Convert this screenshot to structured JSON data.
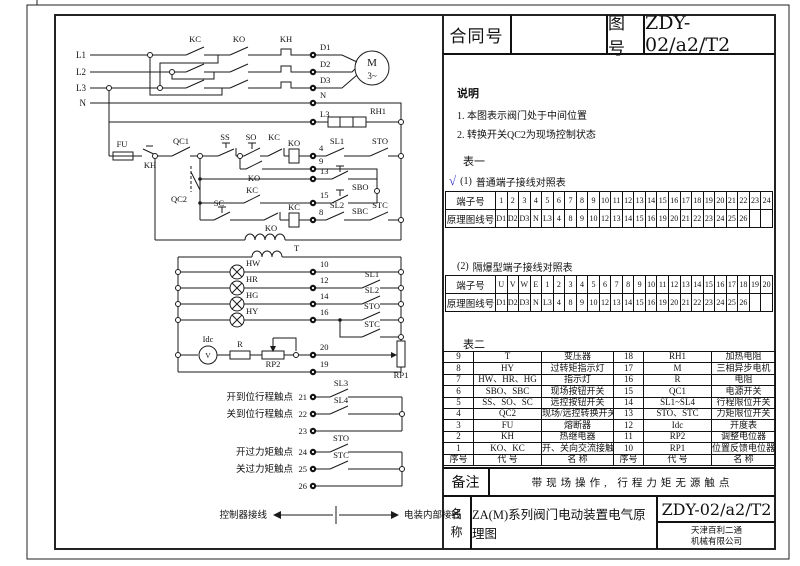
{
  "header": {
    "contract_label": "合同号",
    "contract_value": "",
    "drawing_label": "图号",
    "drawing_value": "ZDY-02/a2/T2"
  },
  "notes": {
    "title": "说明",
    "items": [
      "1. 本图表示阀门处于中间位置",
      "2. 转换开关QC2为现场控制状态"
    ]
  },
  "table1": {
    "title": "表一",
    "check": "√",
    "sub1_label": "(1)",
    "sub1_title": "普通端子接线对照表",
    "row1_header": "端子号",
    "row2_header": "原理图线号",
    "terminals": [
      "1",
      "2",
      "3",
      "4",
      "5",
      "6",
      "7",
      "8",
      "9",
      "10",
      "11",
      "12",
      "13",
      "14",
      "15",
      "16",
      "17",
      "18",
      "19",
      "20",
      "21",
      "22",
      "23",
      "24"
    ],
    "wires": [
      "D1",
      "D2",
      "D3",
      "N",
      "L3",
      "4",
      "8",
      "9",
      "10",
      "12",
      "13",
      "14",
      "15",
      "16",
      "19",
      "20",
      "21",
      "22",
      "23",
      "24",
      "25",
      "26",
      "",
      ""
    ],
    "sub2_label": "(2)",
    "sub2_title": "隔爆型端子接线对照表",
    "ex_terminals": [
      "U",
      "V",
      "W",
      "E",
      "1",
      "2",
      "3",
      "4",
      "5",
      "6",
      "7",
      "8",
      "9",
      "10",
      "11",
      "12",
      "13",
      "14",
      "15",
      "16",
      "17",
      "18",
      "19",
      "20"
    ],
    "ex_wires": [
      "D1",
      "D2",
      "D3",
      "N",
      "L3",
      "4",
      "8",
      "9",
      "10",
      "12",
      "13",
      "14",
      "15",
      "16",
      "19",
      "20",
      "21",
      "22",
      "23",
      "24",
      "25",
      "26",
      "",
      ""
    ]
  },
  "table2": {
    "title": "表二",
    "rows": [
      [
        "9",
        "T",
        "变压器",
        "18",
        "RH1",
        "加热电阻"
      ],
      [
        "8",
        "HY",
        "过转矩指示灯",
        "17",
        "M",
        "三相异步电机"
      ],
      [
        "7",
        "HW、HR、HG",
        "指示灯",
        "16",
        "R",
        "电阻"
      ],
      [
        "6",
        "SBO、SBC",
        "现场按钮开关",
        "15",
        "QC1",
        "电源开关"
      ],
      [
        "5",
        "SS、SO、SC",
        "远控按钮开关",
        "14",
        "SL1~SL4",
        "行程限位开关"
      ],
      [
        "4",
        "QC2",
        "现场/远控转换开关",
        "13",
        "STO、STC",
        "力矩限位开关"
      ],
      [
        "3",
        "FU",
        "熔断器",
        "12",
        "Idc",
        "开度表"
      ],
      [
        "2",
        "KH",
        "热继电器",
        "11",
        "RP2",
        "调整电位器"
      ],
      [
        "1",
        "KO、KC",
        "开、关向交流接触器",
        "10",
        "RP1",
        "位置反馈电位器"
      ],
      [
        "序号",
        "代 号",
        "名 称",
        "序号",
        "代 号",
        "名 称"
      ]
    ]
  },
  "remark": {
    "label": "备注",
    "text": "带现场操作, 行程力矩无源触点"
  },
  "titleblock": {
    "name_label": "名称",
    "name_value": "ZA(M)系列阀门电动装置电气原理图",
    "drawing_no": "ZDY-02/a2/T2",
    "company_line1": "天津百利二通",
    "company_line2": "机械有限公司"
  },
  "schematic": {
    "phases": {
      "l1": "L1",
      "l2": "L2",
      "l3": "L3",
      "n": "N"
    },
    "power": {
      "kc": "KC",
      "ko": "KO",
      "kh": "KH",
      "d1": "D1",
      "d2": "D2",
      "d3": "D3",
      "n": "N",
      "l3": "L3",
      "rh1": "RH1",
      "motor": "M",
      "motor_phase": "3~"
    },
    "control": {
      "fu": "FU",
      "kh": "KH",
      "qc1": "QC1",
      "qc2": "QC2",
      "ss": "SS",
      "so": "SO",
      "sc": "SC",
      "ko": "KO",
      "kc": "KC",
      "t": "T"
    },
    "terms": {
      "t4": "4",
      "t8": "8",
      "t9": "9",
      "t10": "10",
      "t12": "12",
      "t13": "13",
      "t14": "14",
      "t15": "15",
      "t16": "16",
      "t19": "19",
      "t20": "20",
      "t21": "21",
      "t22": "22",
      "t23": "23",
      "t24": "24",
      "t25": "25",
      "t26": "26"
    },
    "switches": {
      "sl1": "SL1",
      "sl2": "SL2",
      "sl3": "SL3",
      "sl4": "SL4",
      "sto": "STO",
      "stc": "STC",
      "sbo": "SBO",
      "sbc": "SBC"
    },
    "lamps": {
      "hw": "HW",
      "hr": "HR",
      "hg": "HG",
      "hy": "HY"
    },
    "meter": {
      "idc": "Idc",
      "v": "V",
      "r": "R",
      "rp1": "RP1",
      "rp2": "RP2"
    },
    "captions": {
      "open_travel": "开到位行程触点",
      "close_travel": "关到位行程触点",
      "open_torque": "开过力矩触点",
      "close_torque": "关过力矩触点",
      "controller": "控制器接线",
      "internal": "电装内部接线"
    },
    "accent_check_color": "#3b3bd1"
  }
}
